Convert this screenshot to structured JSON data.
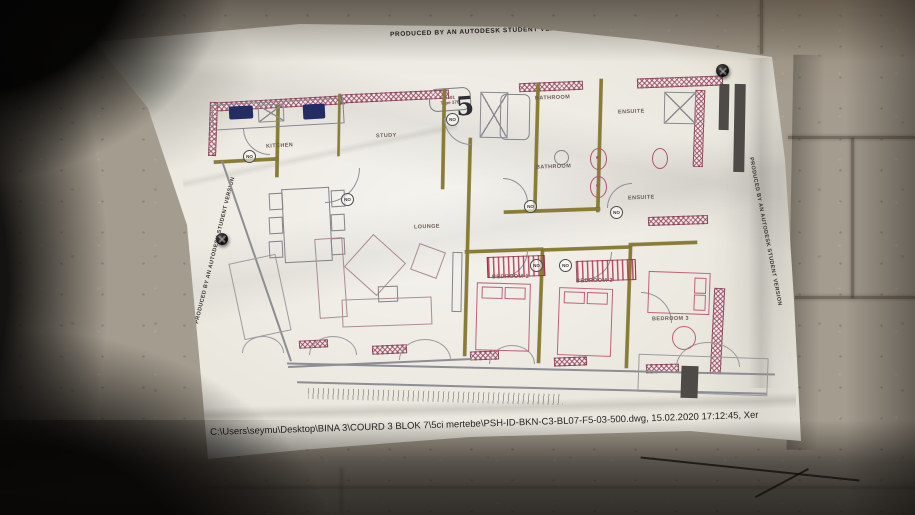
{
  "photo": {
    "watermark": "PRODUCED BY AN AUTODESK STUDENT VERSION",
    "footer_line": "C:\\Users\\seymu\\Desktop\\BINA 3\\COURD 3 BLOK 7\\5ci mertebe\\PSH-ID-BKN-C3-BL07-F5-03-500.dwg, 15.02.2020 17:12:45, Xer"
  },
  "plan": {
    "unit_code": "7501",
    "unit_type": "Type 37E",
    "flat_number": "5",
    "door_tag": "NO",
    "rooms": {
      "kitchen": "KITCHEN",
      "study": "STUDY",
      "lounge": "LOUNGE",
      "bathroom_upper": "BATHROOM",
      "ensuite_upper": "ENSUITE",
      "bathroom_lower": "BATHROOM",
      "ensuite_lower": "ENSUITE",
      "bedroom1": "BEDROOM 1",
      "bedroom2": "BEDROOM 2",
      "bedroom3": "BEDROOM 3"
    }
  },
  "colors": {
    "wall_hatch": "#93415a",
    "partition": "#8a7d33",
    "furniture_outline": "#c2607a",
    "wardrobe_stripe": "#b3334f",
    "fixture_navy": "#232d63",
    "paper": "#e9e6dc",
    "wall": "#a49c8e"
  }
}
